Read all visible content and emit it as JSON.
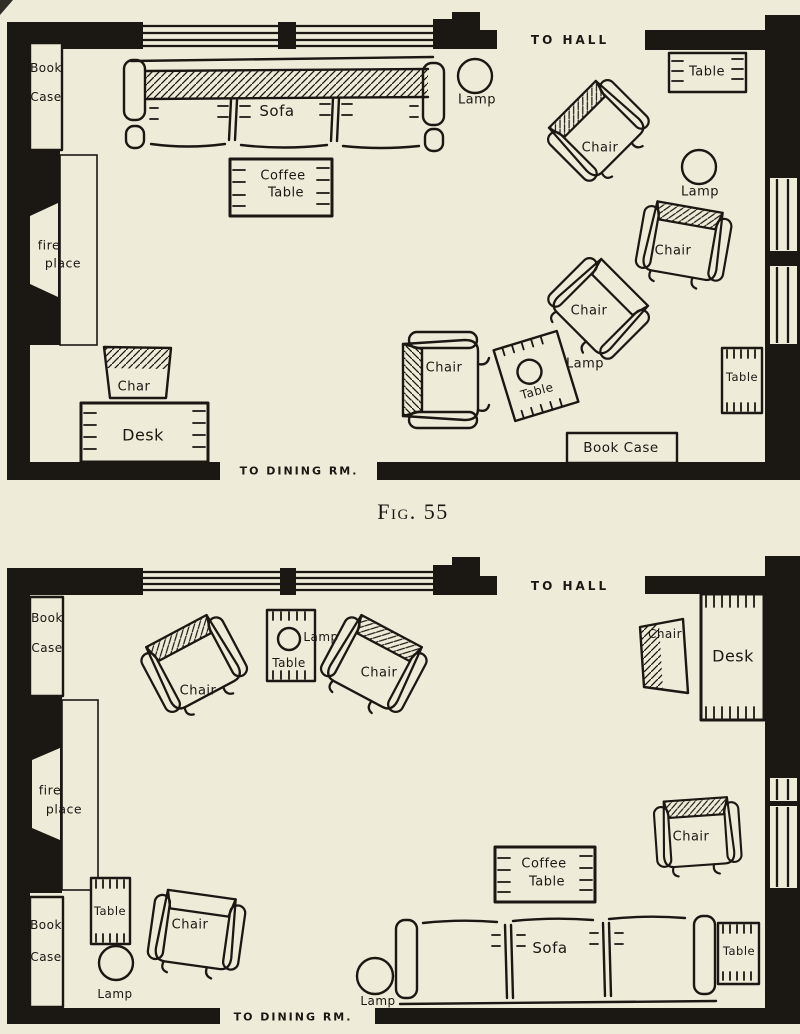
{
  "figure": {
    "caption": "Fig. 55"
  },
  "colors": {
    "paper": "#efebd9",
    "ink": "#1b1712"
  },
  "plan1": {
    "to_hall": "TO HALL",
    "to_dining": "TO DINING RM.",
    "bookcase_wall_line1": "Book",
    "bookcase_wall_line2": "Case",
    "fireplace_line1": "fire",
    "fireplace_line2": "place",
    "sofa": "Sofa",
    "coffee_table_line1": "Coffee",
    "coffee_table_line2": "Table",
    "lamp_by_sofa": "Lamp",
    "corner_table": "Table",
    "chair_top": "Chair",
    "lamp_right_wall": "Lamp",
    "chair_right": "Chair",
    "chair_middle": "Chair",
    "chair_left": "Chair",
    "lamp_on_side_table": "Lamp",
    "side_table": "Table",
    "table_right_wall": "Table",
    "bookcase_bottom": "Book Case",
    "desk_chair": "Char",
    "desk": "Desk"
  },
  "plan2": {
    "to_hall": "TO HALL",
    "to_dining": "TO DINING RM.",
    "bookcase_top_line1": "Book",
    "bookcase_top_line2": "Case",
    "bookcase_bottom_line1": "Book",
    "bookcase_bottom_line2": "Case",
    "fireplace_line1": "fire",
    "fireplace_line2": "place",
    "chair_window_left": "Chair",
    "lamp_table_lamp": "Lamp",
    "lamp_table": "Table",
    "chair_window_right": "Chair",
    "desk_chair": "Chair",
    "desk": "Desk",
    "chair_right_wall": "Chair",
    "coffee_table_line1": "Coffee",
    "coffee_table_line2": "Table",
    "side_table_left": "Table",
    "chair_fireplace": "Chair",
    "lamp_left": "Lamp",
    "sofa": "Sofa",
    "table_by_sofa": "Table",
    "lamp_center": "Lamp"
  }
}
